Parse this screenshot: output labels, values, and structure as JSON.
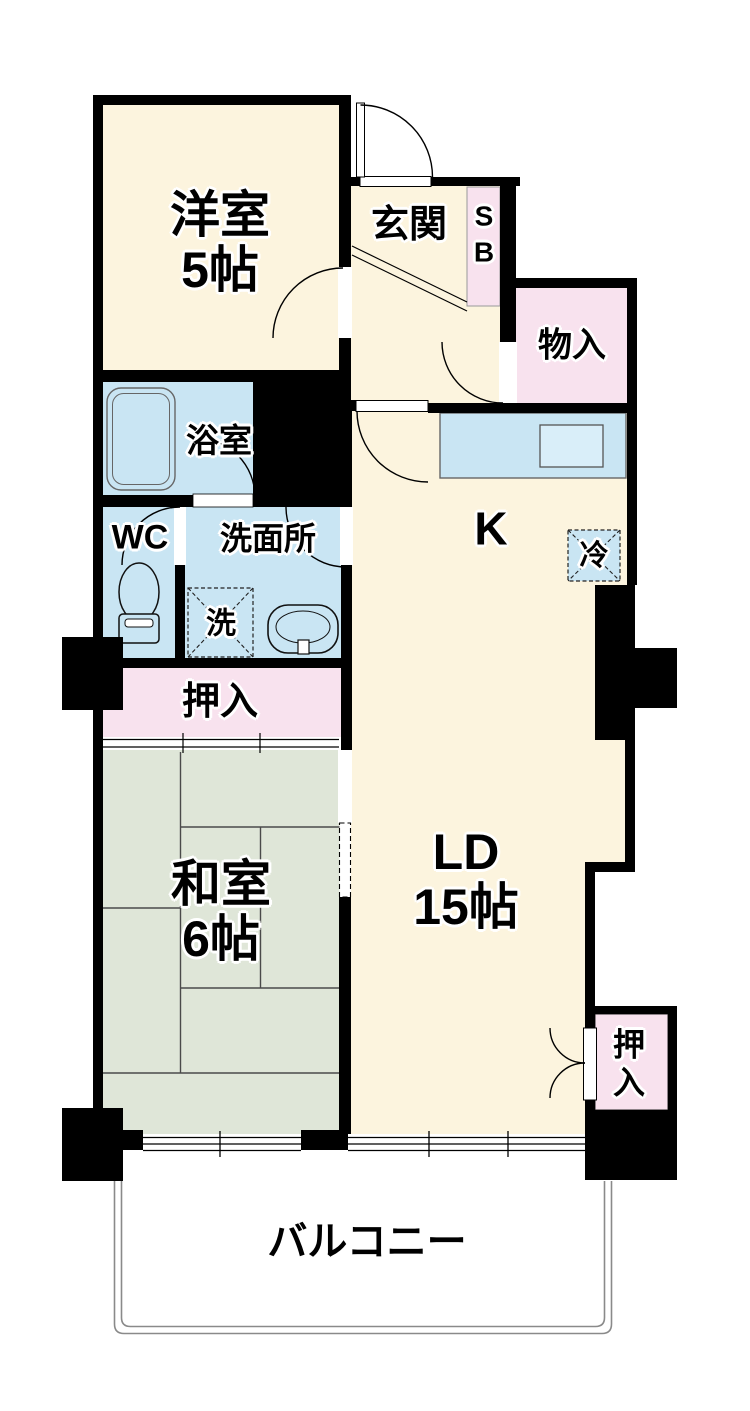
{
  "palette": {
    "wall_black": "#000000",
    "room_cream": "#FCF4DE",
    "closet_pink": "#F8E2EE",
    "water_blue": "#C9E5F3",
    "tatami_green": "#DFE6D8",
    "balcony_line_gray": "#8A8A8A"
  },
  "rooms": {
    "western_room": {
      "name": "洋室",
      "size": "5帖"
    },
    "entrance": {
      "name": "玄関"
    },
    "shoe_box": {
      "line1": "S",
      "line2": "B"
    },
    "storage": {
      "name": "物入"
    },
    "bathroom": {
      "name": "浴室"
    },
    "toilet": {
      "name": "WC"
    },
    "washroom": {
      "name": "洗面所"
    },
    "washer": {
      "name": "洗"
    },
    "kitchen": {
      "name": "K"
    },
    "refrigerator": {
      "name": "冷"
    },
    "closet_hallway": {
      "name": "押入"
    },
    "japanese_room": {
      "name": "和室",
      "size": "6帖"
    },
    "living_dining": {
      "name": "LD",
      "size": "15帖"
    },
    "closet_ld": {
      "line1": "押",
      "line2": "入"
    },
    "balcony": {
      "name": "バルコニー"
    }
  }
}
